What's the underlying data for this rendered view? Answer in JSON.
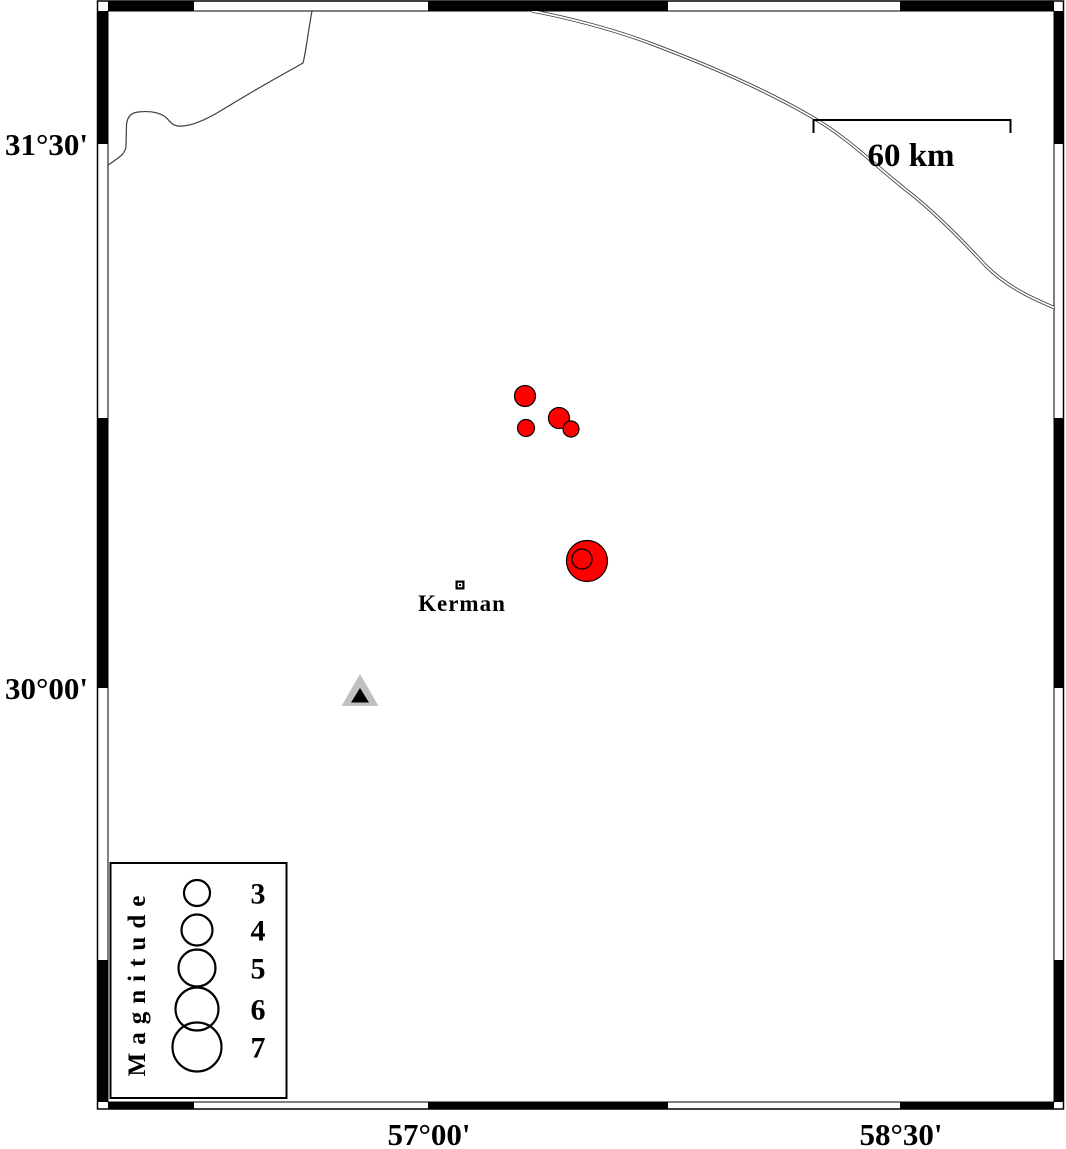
{
  "map": {
    "axis": {
      "left": [
        {
          "label": "31°30'",
          "y": 144
        },
        {
          "label": "30°00'",
          "y": 688
        }
      ],
      "bottom": [
        {
          "label": "57°00'",
          "x": 429
        },
        {
          "label": "58°30'",
          "x": 901
        }
      ]
    },
    "frame": {
      "segments": {
        "top": [
          [
            108,
            194
          ],
          [
            428,
            668
          ],
          [
            900,
            1054
          ]
        ],
        "bottom": [
          [
            108,
            194
          ],
          [
            428,
            668
          ],
          [
            900,
            1054
          ]
        ],
        "left": [
          [
            11,
            144
          ],
          [
            418,
            688
          ],
          [
            960,
            1102
          ]
        ],
        "right": [
          [
            11,
            144
          ],
          [
            418,
            688
          ],
          [
            960,
            1102
          ]
        ]
      }
    },
    "scale_bar": {
      "label": "60 km"
    },
    "city": {
      "label": "Kerman",
      "x": 460,
      "y": 585
    },
    "station": {
      "x": 360,
      "y": 692
    },
    "epicenters": [
      {
        "x": 525,
        "y": 396,
        "r": 10.5
      },
      {
        "x": 526,
        "y": 428,
        "r": 8.5
      },
      {
        "x": 559,
        "y": 418,
        "r": 10.5
      },
      {
        "x": 571,
        "y": 429,
        "r": 8
      },
      {
        "x": 587,
        "y": 561,
        "r": 20.5,
        "ring": {
          "x": 582,
          "y": 559,
          "r": 10
        }
      }
    ],
    "lines": [
      {
        "name": "boundary-line",
        "style": "single",
        "d": "M312,11 C308,32 306,52 303,63 L296,67 C278,77 248,94 222,110 C204,121 189,127 178,126 C171,125.5 169,119 164,116 C157,111.5 147,111 138,112 C130,113 127,118 126.5,125 L126,146 C125.5,153 121,156 114,161 L104,168"
      },
      {
        "name": "road-double-line",
        "style": "double",
        "d": "M532,11 C560,16 610,28 652,44 C700,62 762,88 812,117 C850,139 880,170 910,193 C934,212 962,240 986,266 C1008,288 1036,300 1055,308"
      }
    ],
    "colors": {
      "epicenter_fill": "#ff0000",
      "station_outer": "#c0c0c0",
      "station_inner": "#000000",
      "line": "#3f3f3f",
      "frame": "#000000"
    }
  },
  "legend": {
    "title": "Magnitude",
    "entries": [
      {
        "value": "3",
        "cy": 893,
        "r": 13
      },
      {
        "value": "4",
        "cy": 930,
        "r": 15.5
      },
      {
        "value": "5",
        "cy": 968,
        "r": 18.5
      },
      {
        "value": "6",
        "cy": 1009,
        "r": 21.5
      },
      {
        "value": "7",
        "cy": 1047,
        "r": 24.5
      }
    ]
  }
}
